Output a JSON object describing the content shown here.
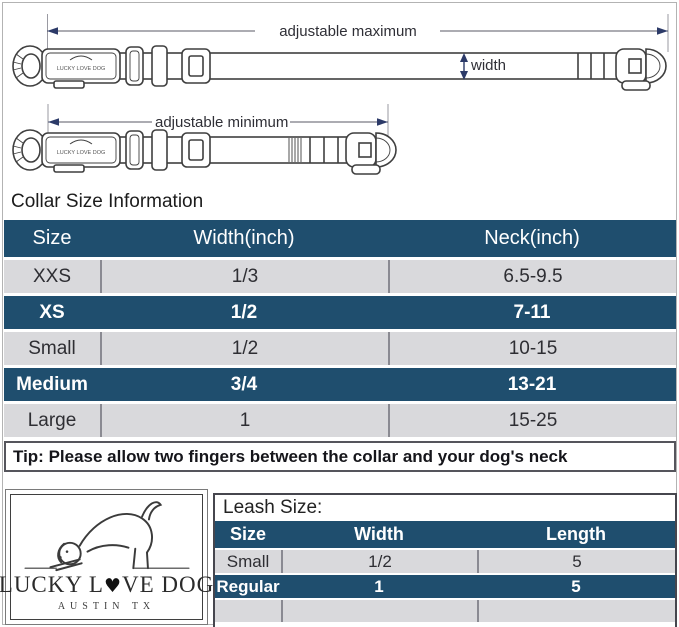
{
  "diagram": {
    "label_adjustable_maximum": "adjustable maximum",
    "label_adjustable_minimum": "adjustable minimum",
    "label_width": "width",
    "buckle_text": "LUCKY LOVE DOG"
  },
  "collar_section": {
    "title": "Collar Size Information",
    "table": {
      "headers": [
        "Size",
        "Width(inch)",
        "Neck(inch)"
      ],
      "rows": [
        {
          "size": "XXS",
          "width": "1/3",
          "neck": "6.5-9.5",
          "highlight": false
        },
        {
          "size": "XS",
          "width": "1/2",
          "neck": "7-11",
          "highlight": true
        },
        {
          "size": "Small",
          "width": "1/2",
          "neck": "10-15",
          "highlight": false
        },
        {
          "size": "Medium",
          "width": "3/4",
          "neck": "13-21",
          "highlight": true
        },
        {
          "size": "Large",
          "width": "1",
          "neck": "15-25",
          "highlight": false
        }
      ]
    },
    "tip": "Tip: Please allow two fingers between the collar and your dog's neck"
  },
  "logo": {
    "brand_part1": "LUCKY L",
    "brand_heart": "♥",
    "brand_part2": "VE DOG",
    "location": "AUSTIN TX"
  },
  "leash_section": {
    "title": "Leash Size:",
    "table": {
      "headers": [
        "Size",
        "Width",
        "Length"
      ],
      "rows": [
        {
          "size": "Small",
          "width": "1/2",
          "length": "5",
          "highlight": false
        },
        {
          "size": "Regular",
          "width": "1",
          "length": "5",
          "highlight": true
        }
      ]
    }
  },
  "colors": {
    "header_navy": "#1f4e6e",
    "row_gray": "#d9d9dc",
    "arrow_navy": "#2c3a68",
    "line_gray": "#8a8a92"
  }
}
